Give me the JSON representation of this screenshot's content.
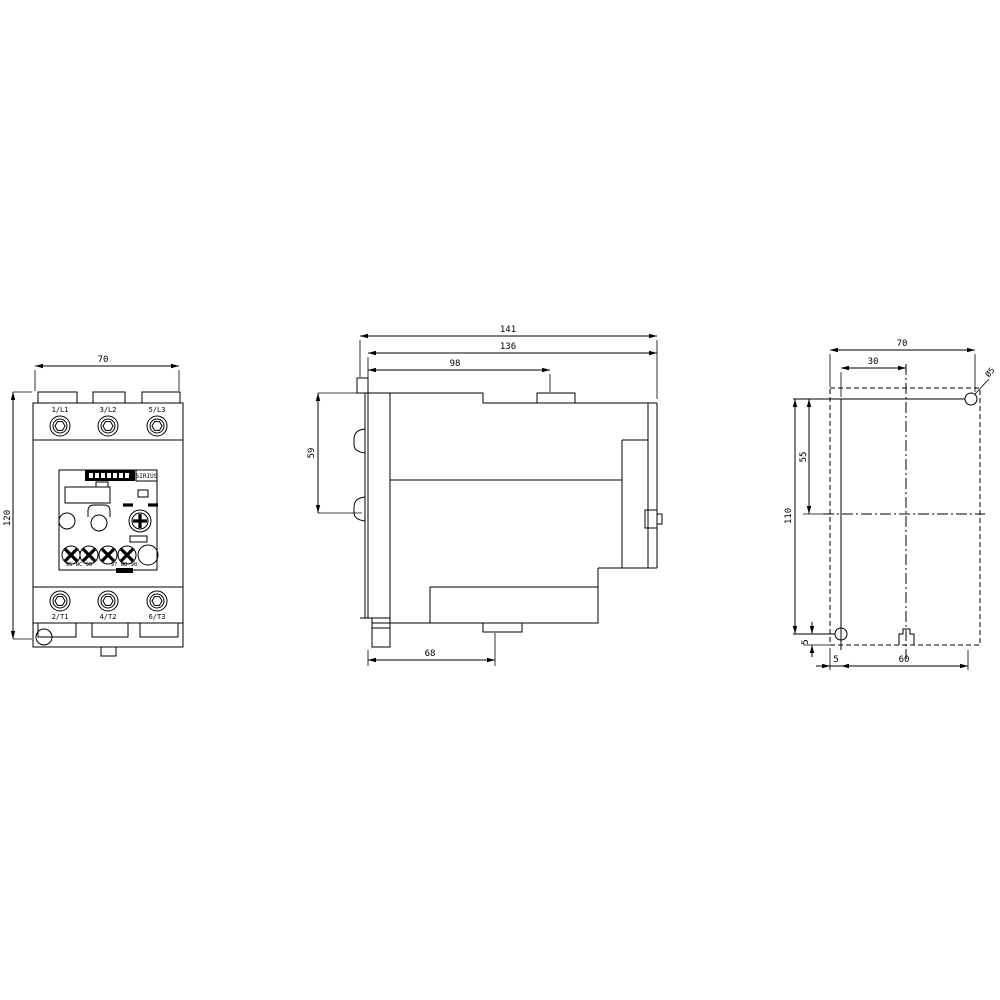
{
  "front_view": {
    "dim_width": "70",
    "dim_height": "120",
    "terminals_top": [
      "1/L1",
      "3/L2",
      "5/L3"
    ],
    "terminals_bottom": [
      "2/T1",
      "4/T2",
      "6/T3"
    ],
    "brand_label": "SIRIUS",
    "aux_terminals_left": "95 NC 96",
    "aux_terminals_right": "97 NO 98"
  },
  "side_view": {
    "dim_depth_overall": "141",
    "dim_depth_body": "136",
    "dim_tab_position": "98",
    "dim_height_upper": "59",
    "dim_depth_lower": "68"
  },
  "rear_view": {
    "dim_width": "70",
    "dim_slot_offset": "30",
    "hole_diameter": "Ø5",
    "dim_hole_pitch_vertical": "110",
    "dim_centerline_offset": "55",
    "dim_hole_edge_vertical": "5",
    "dim_hole_edge_horizontal": "5",
    "dim_hole_pitch_horizontal": "60"
  },
  "colors": {
    "line": "#000000",
    "background": "#ffffff"
  }
}
